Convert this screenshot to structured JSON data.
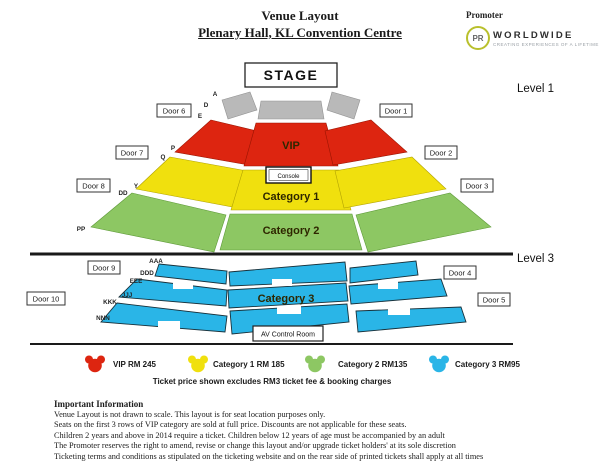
{
  "header": {
    "title": "Venue Layout",
    "subtitle": "Plenary Hall, KL Convention Centre"
  },
  "promoter": {
    "label": "Promoter",
    "circle_text": "PR",
    "name": "WORLDWIDE",
    "tagline": "CREATING EXPERIENCES OF A LIFETIME"
  },
  "map": {
    "stage_label": "STAGE",
    "level1_label": "Level 1",
    "level3_label": "Level 3",
    "console_label": "Console",
    "av_room_label": "AV Control Room",
    "sections": {
      "vip": "VIP",
      "cat1": "Category 1",
      "cat2": "Category 2",
      "cat3": "Category 3"
    },
    "doors": [
      "Door 1",
      "Door 2",
      "Door 3",
      "Door 4",
      "Door 5",
      "Door 6",
      "Door 7",
      "Door 8",
      "Door 9",
      "Door 10"
    ],
    "row_labels_level1": [
      "A",
      "D",
      "E",
      "P",
      "Q",
      "Y",
      "DD",
      "PP"
    ],
    "row_labels_level3": [
      "AAA",
      "DDD",
      "EEE",
      "JJJ",
      "KKK",
      "NNN"
    ]
  },
  "legend": {
    "items": [
      {
        "label": "VIP RM 245",
        "color": "#dd2510"
      },
      {
        "label": "Category 1 RM 185",
        "color": "#f0e00e"
      },
      {
        "label": "Category 2 RM135",
        "color": "#8dc763"
      },
      {
        "label": "Category 3 RM95",
        "color": "#2ab5e7"
      }
    ],
    "note": "Ticket price shown excludes RM3 ticket fee & booking charges"
  },
  "info": {
    "heading": "Important Information",
    "lines": [
      "Venue Layout is not drawn to scale.  This layout is for seat location purposes only.",
      "Seats on the first 3 rows of VIP category are sold at full price.  Discounts are not applicable for these seats.",
      "Children 2 years and above in 2014 require a ticket.  Children below 12 years of age must be accompanied by an adult",
      "The Promoter reserves the right to amend, revise or change this layout and/or upgrade ticket holders' at its sole discretion",
      "Ticketing terms and conditions as stipulated on the ticketing website and on the rear side of printed tickets shall apply at all times"
    ]
  },
  "colors": {
    "vip": "#dd2510",
    "cat1": "#f0e00e",
    "cat2": "#8dc763",
    "cat3": "#2ab5e7",
    "gray": "#b9b9b9"
  }
}
